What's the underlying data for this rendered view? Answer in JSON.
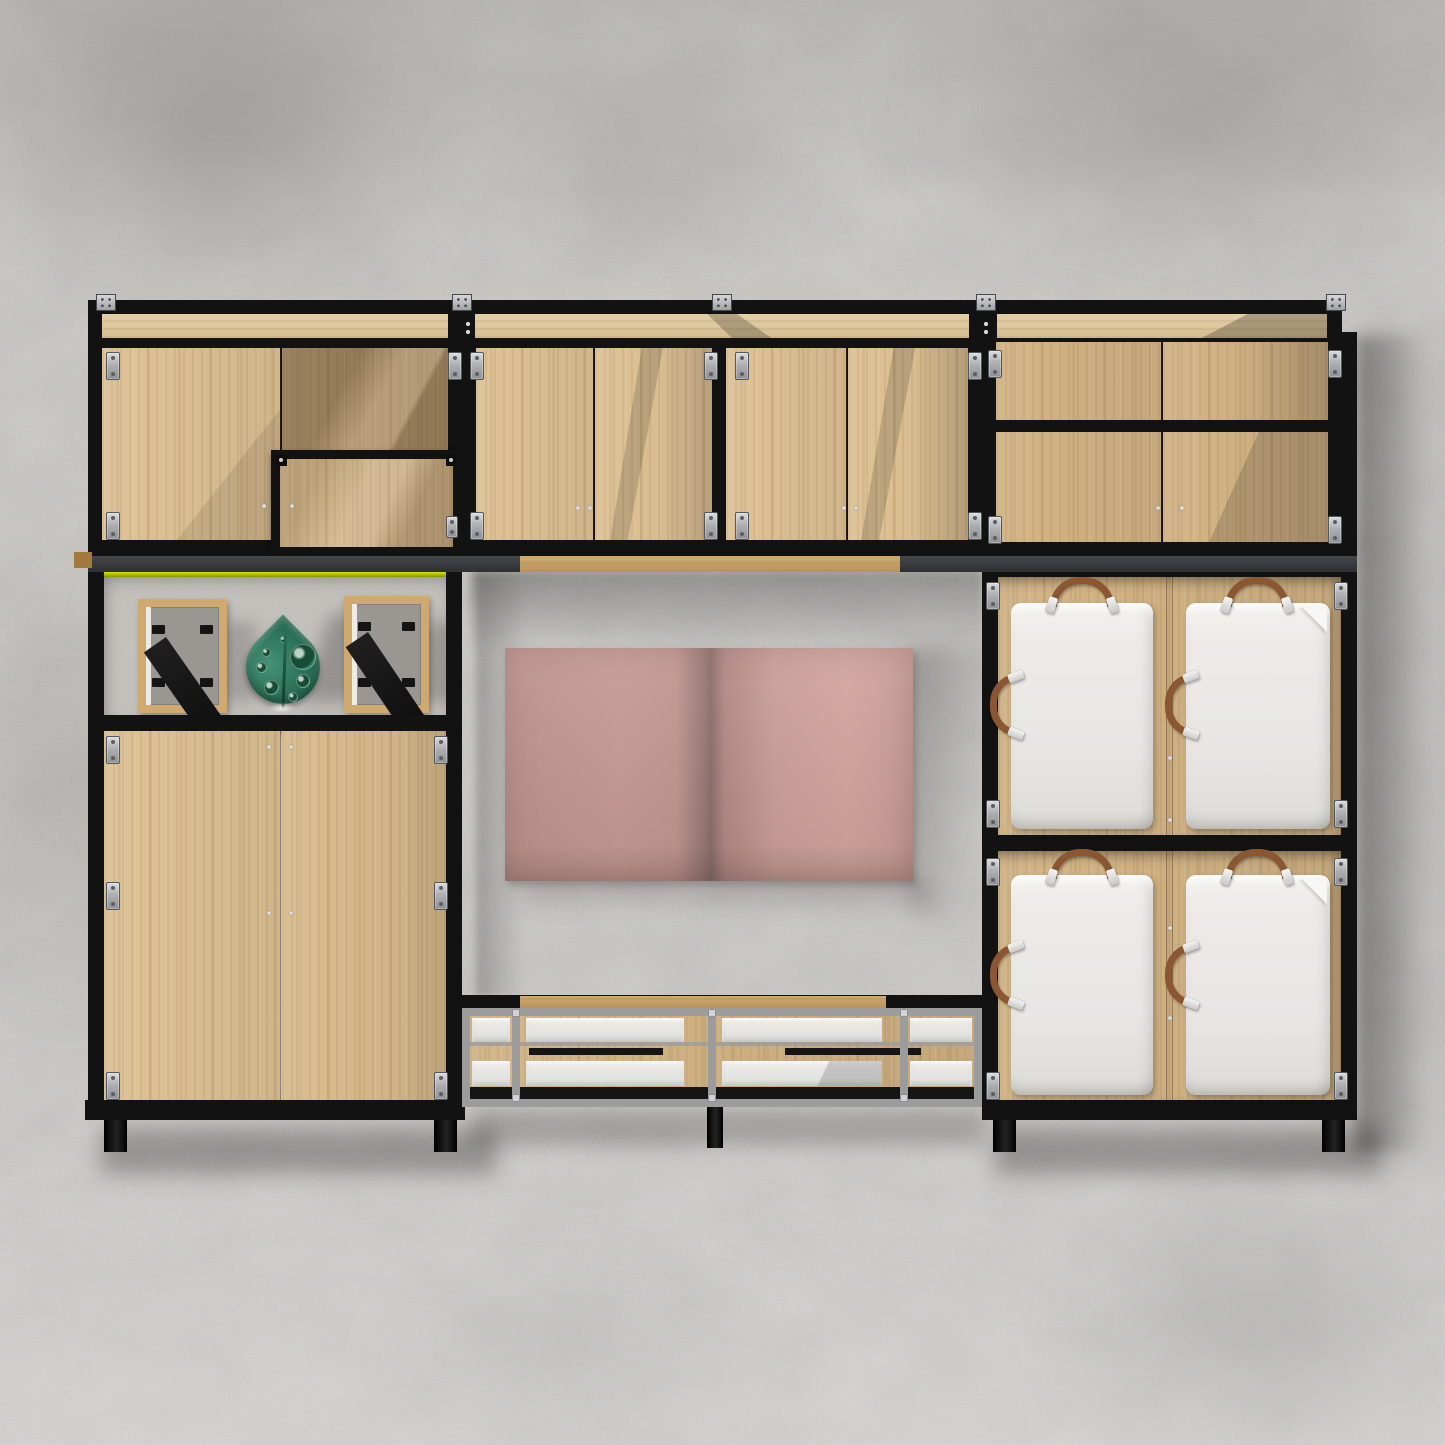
{
  "scene": {
    "kind": "3D furniture render on concrete wall",
    "description": "Modular black-steel-frame wall unit with oak panels: four upper cabinets, an open display shelf holding two picture frames and a green leaf sculpture, a tall two-door cabinet, an open TV niche with a wall-mounted TV, a low gray-framed media bench with two handle drawers, and a 2x2 grid of white upholstered doors with brown leather strap handles.",
    "colors": {
      "wall": "#d4d2ce",
      "wall_shade": "#9b9893",
      "frame_black": "#121212",
      "rail_gray": "#3b3c3f",
      "metal_gray": "#9c9c9c",
      "oak_light": "#dcc093",
      "oak_mid": "#d0b284",
      "oak_dark": "#b2946a",
      "oak_strip": "#e2c99c",
      "oak_kick": "#c79e61",
      "tv_screen_pink": "#c89c95",
      "tv_seam_dark": "#8d6f6d",
      "cushion_white": "#ebeae7",
      "strap_brown": "#8a5732",
      "sculpture_green": "#2f7d62",
      "sculpture_green_dark": "#1d5a44",
      "shelf_accent_yellow": "#c6d300",
      "hinge_silver": "#c3c5c9"
    },
    "objects": [
      "upper cabinet left with inset framed door",
      "upper cabinet center with two double-door bays",
      "upper cabinet right with short drawer row and double doors",
      "open display shelf with two back-facing picture frames and green leaf sculpture",
      "tall two-door oak cabinet",
      "wall-mounted tv with pink reflection",
      "low media bench with white panels and black handle bars",
      "four white upholstered locker doors with leather straps",
      "black support legs",
      "concrete wall background"
    ]
  }
}
